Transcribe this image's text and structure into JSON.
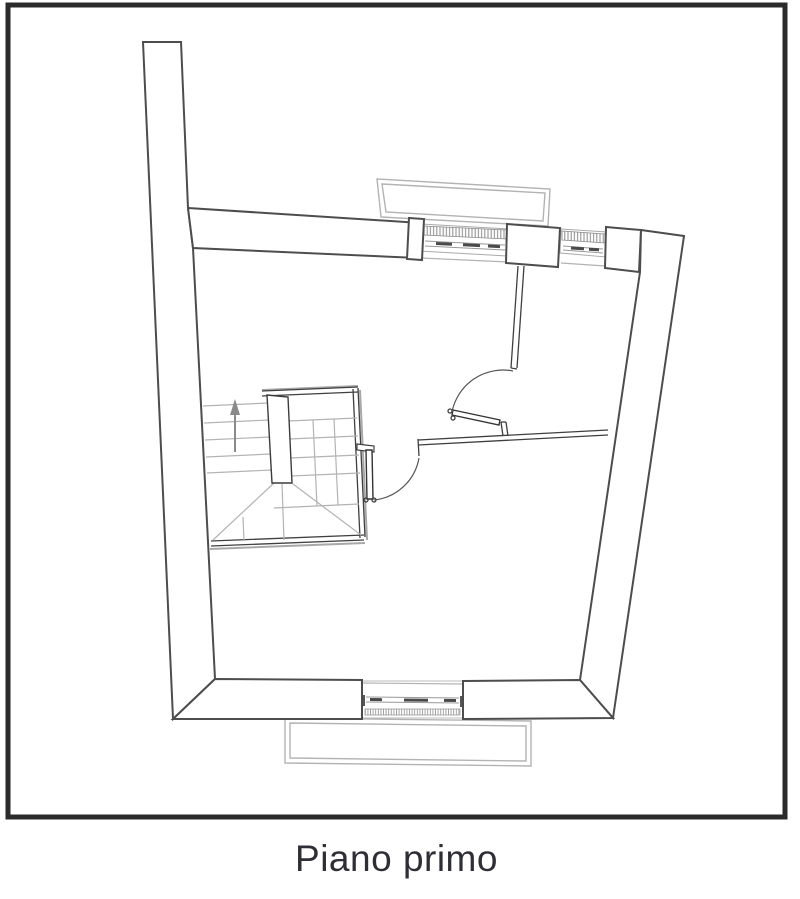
{
  "caption": "Piano primo",
  "colors": {
    "frame": "#2b2b2b",
    "wall_line": "#4d4d4d",
    "medium_line": "#8a8a8a",
    "light_line": "#b3b3b3",
    "caption_text": "#2e2e36",
    "paper": "#ffffff"
  },
  "plan": {
    "type": "architectural-floor-plan",
    "elements": [
      "exterior-walls",
      "top-balcony",
      "bottom-balcony",
      "top-window-left",
      "top-window-right",
      "bottom-window",
      "pillar",
      "staircase",
      "stair-up-arrow-icon",
      "stair-door",
      "room-door",
      "interior-partition-walls"
    ]
  }
}
